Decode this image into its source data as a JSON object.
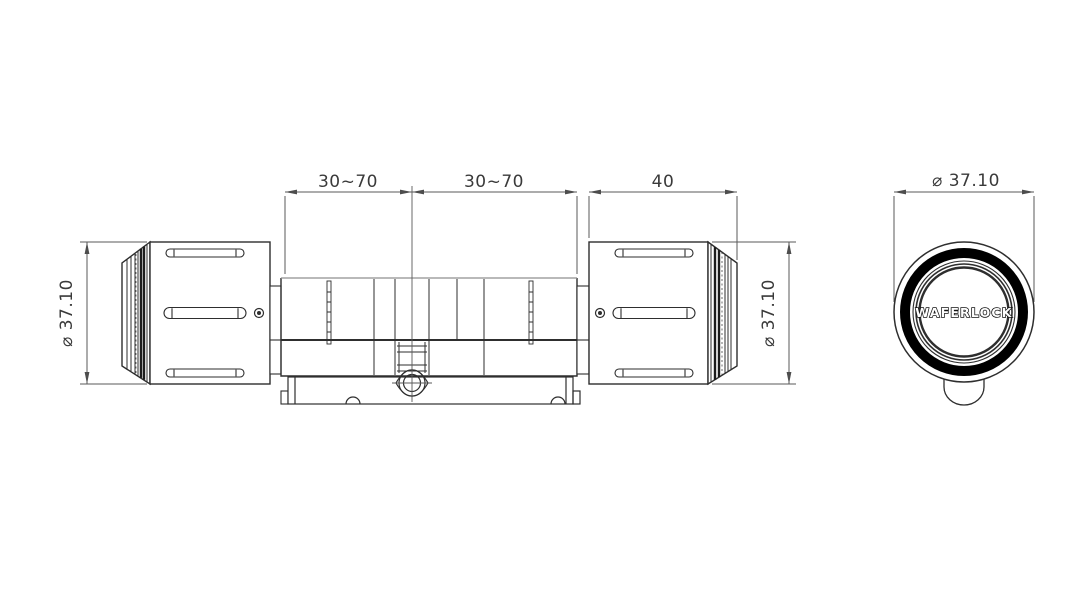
{
  "side_view": {
    "dims": {
      "span_left": "30~70",
      "span_right": "30~70",
      "knob_length": "40",
      "knob_diameter_left": "⌀ 37.10",
      "knob_diameter_right": "⌀ 37.10"
    }
  },
  "front_view": {
    "knob_diameter": "⌀ 37.10",
    "brand": "WAFERLOCK"
  },
  "colors": {
    "outline": "#2e2e2e",
    "dimension_line": "#5a5a5a",
    "ring": "#000000",
    "background": "#ffffff"
  }
}
